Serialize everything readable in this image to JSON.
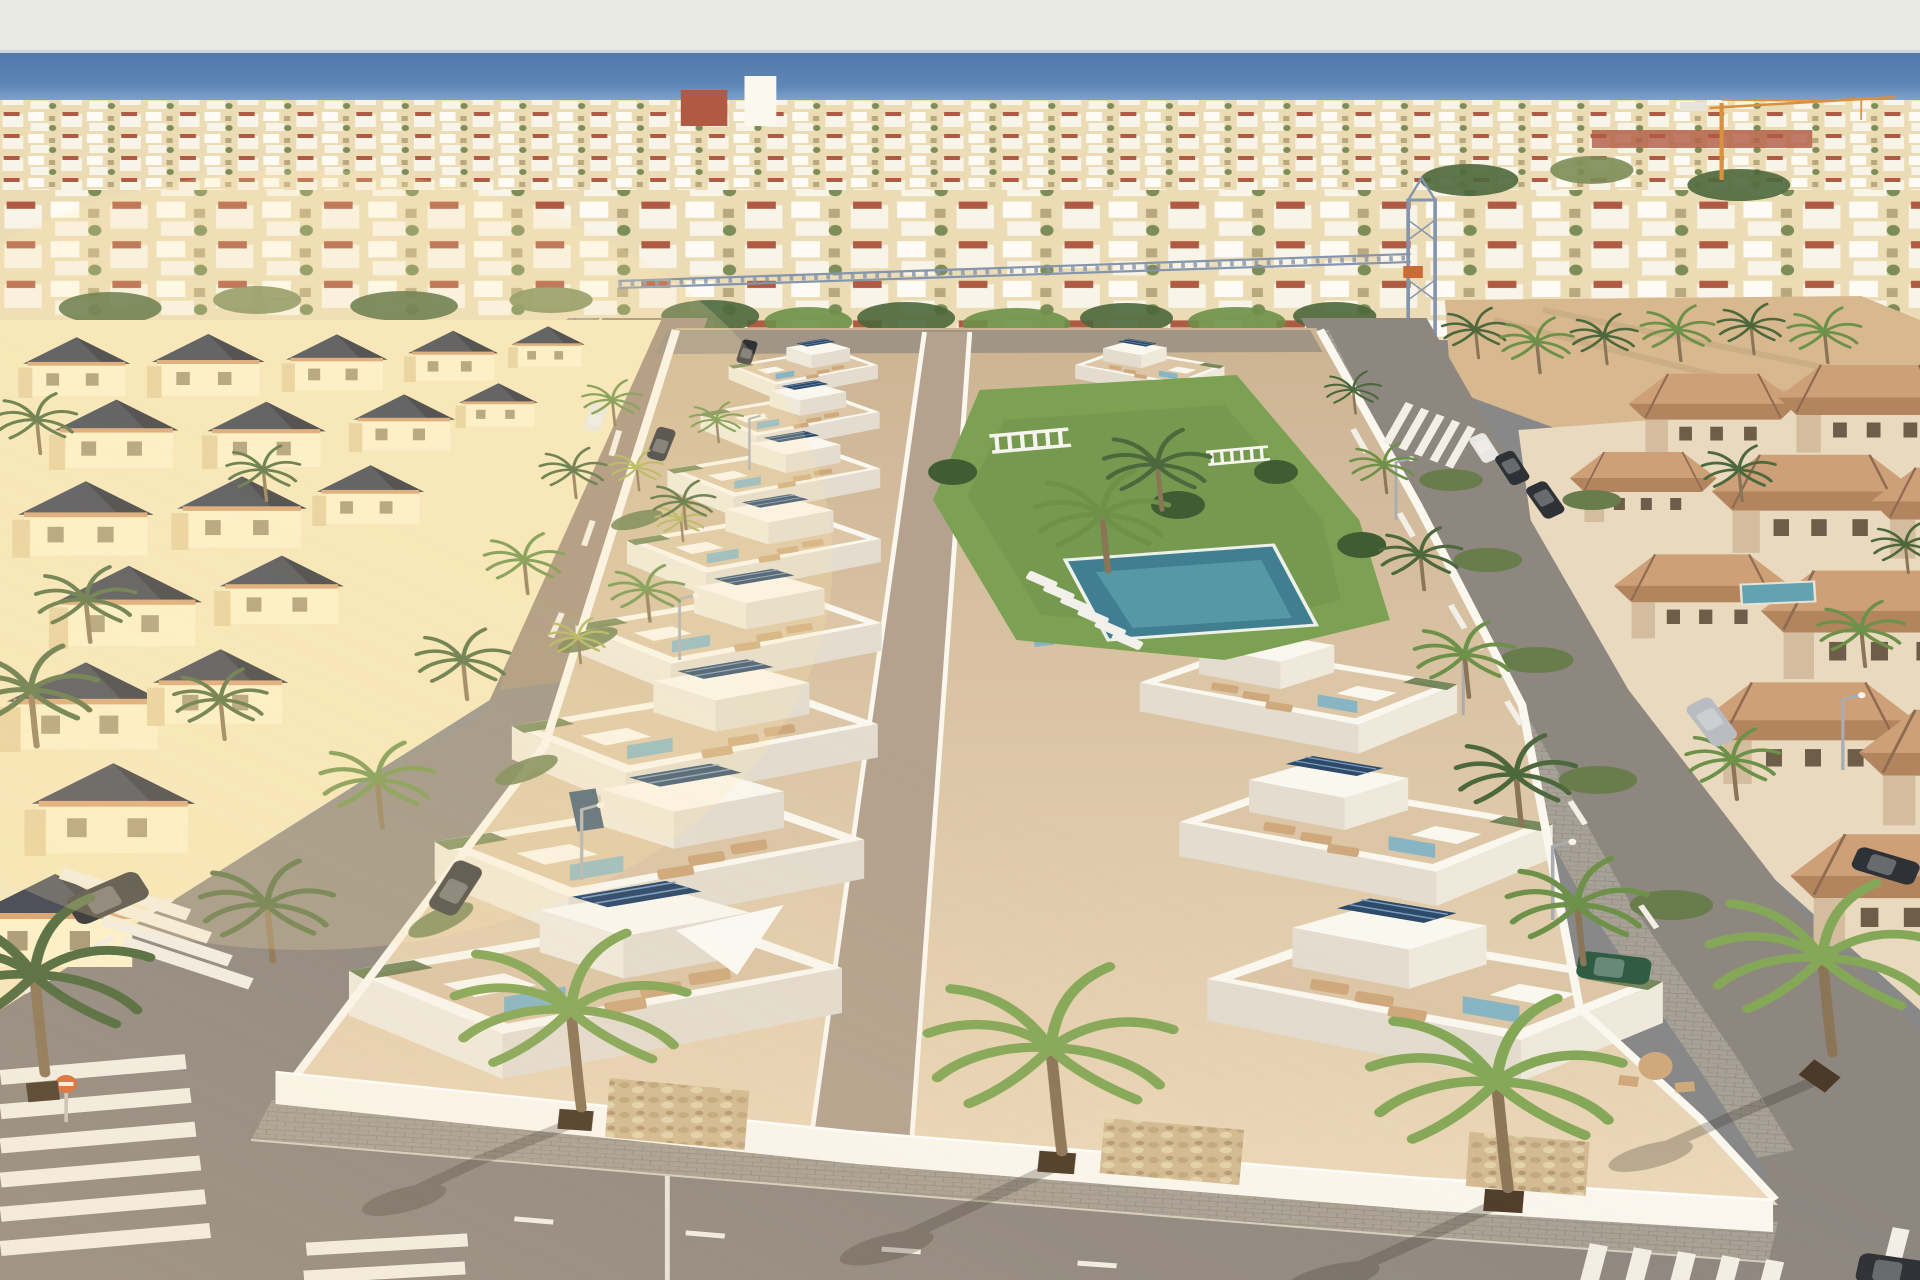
{
  "meta": {
    "kind": "aerial-architectural-render",
    "subject": "Sunset aerial render of a new beachside residential development of white villas with roof terraces, solar panels and a communal pool garden, set inside an existing coastal town with cream and terracotta villas, palm-lined streets and the sea on the horizon"
  },
  "palette": {
    "sky": "#e9eae4",
    "sea_deep": "#4f7aac",
    "sea_mid": "#5e86b6",
    "sea_light": "#8aabd0",
    "horizon": "#ccd6de",
    "town_base": "#ecdcb6",
    "town_white": "#f8f4e8",
    "town_red": "#b05a43",
    "town_green": "#7c8d58",
    "sand": "#d8b88e",
    "sand_dark": "#c5a67e",
    "cream_sun": "#fdf3cd",
    "cream_wall": "#f6e8bd",
    "cream_shadow": "#e6d09e",
    "cream_roof": "#3a4052",
    "cream_roof_dark": "#272c3a",
    "scallop": "#d8a273",
    "terr_wall": "#e9d9bf",
    "terr_wall_shadow": "#d3bd9e",
    "terr_roof": "#b3855f",
    "terr_roof_light": "#cda078",
    "terr_roof_dark": "#8f6b52",
    "dev_top": "#ccb493",
    "dev_bottom": "#ecd9ba",
    "terrace": "#dcc6a6",
    "path": "#b4a28f",
    "wall_white": "#faf7ef",
    "wall_shadow": "#e3dccf",
    "wall_side": "#efe9dc",
    "stone": "#d2ba92",
    "lawn": "#7ca153",
    "lawn_dark": "#5f8440",
    "pool": "#3f7f90",
    "pool_light": "#63a3b1",
    "glass": "#7eb2c6",
    "solar": "#2d4a6b",
    "solar_line": "#7e9cbe",
    "asphalt": "#8e8780",
    "asphalt_warm": "#b29377",
    "sidewalk": "#a8a196",
    "sidewalk_line": "#918a7d",
    "marking": "#f2efe6",
    "palm_dark": "#4c683c",
    "palm_mid": "#6d9148",
    "palm_light": "#85a858",
    "palm_yellow": "#aab157",
    "trunk": "#8a7556",
    "hedge": "#687c4c",
    "lounge": "#cfa97c",
    "car_dark": "#2e3136",
    "car_white": "#e8e7e3",
    "car_silver": "#b9bcc0",
    "car_green": "#2f5c43",
    "crane_orange": "#d8913f",
    "crane_blue": "#8495ac",
    "sign_orange": "#d96b35",
    "shadow": "#3a332b",
    "planter": "#4b3a28"
  },
  "scene": {
    "sky": {
      "label": "hazy pale evening sky"
    },
    "sea": {
      "label": "sea horizon band"
    },
    "distant_town": {
      "label": "dense low-rise coastal town"
    },
    "cranes": [
      {
        "label": "orange tower crane near the shore"
      },
      {
        "label": "grey lattice tower crane with long jib over the town"
      }
    ],
    "left_neighborhood": {
      "label": "cream villas with dark pyramid roofs and scalloped tile parapets"
    },
    "new_development": {
      "label": "two rows of white flat-roof villas with roof terraces, teal glass balconies and rooftop solar panels"
    },
    "pool_garden": {
      "label": "communal lawn with pool, white pergola, benches and sun loungers"
    },
    "right_neighborhood": {
      "label": "beige villas with terracotta hipped roofs, private pools and hedges"
    },
    "sandy_lot": {
      "label": "empty sandy building plot"
    },
    "streets": {
      "label": "asphalt streets with palm trees, street lights, lane dashes and zebra crossings"
    },
    "vehicles": {
      "labels": [
        "dark cars",
        "white car",
        "silver suv",
        "green car in driveway"
      ]
    },
    "signage": {
      "label": "small round orange traffic sign"
    }
  }
}
